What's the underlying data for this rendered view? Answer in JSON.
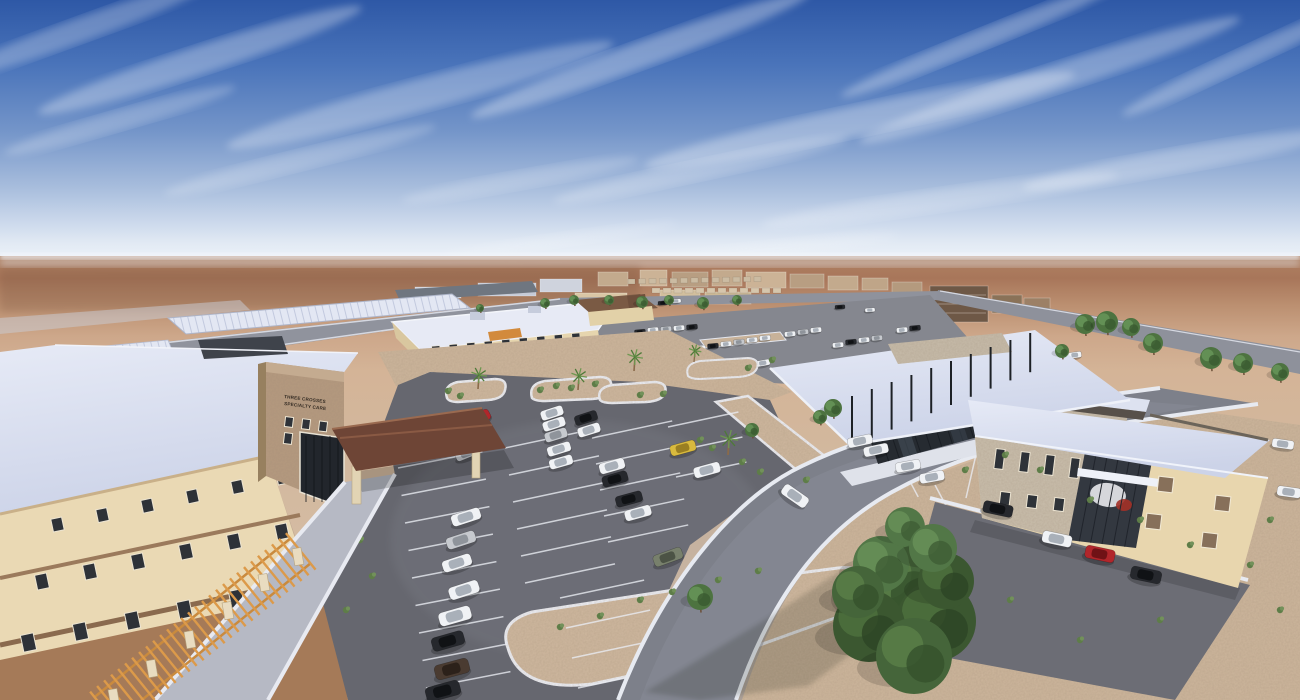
{
  "scene": {
    "description": "Aerial architectural rendering of a desert medical campus with parking lots",
    "sign": {
      "line1": "THREE CROSSES",
      "line2": "SPECIALTY CARE"
    }
  },
  "palette": {
    "sky_top": "#2e58a6",
    "sky_low": "#cdd9ec",
    "horizon_haze": "#eef3f9",
    "desert_far": "#a8765a",
    "desert_near": "#d5bea7",
    "gravel": "#cdb69c",
    "asphalt": "#66676f",
    "road": "#8f929c",
    "sidewalk": "#e8eaf1",
    "roof_white": "#dde2f2",
    "stucco": "#ead9b4",
    "brick": "#b59a7f",
    "stone": "#c9beac",
    "wood": "#dc9a4a",
    "canopy_brown": "#6e4536",
    "glass": "#262b31",
    "tree_green": "#45653a",
    "car_colors": {
      "W": [
        "#f0f2f5",
        "#a9b0b9"
      ],
      "S": [
        "#c6c9ce",
        "#8f949b"
      ],
      "K": [
        "#26282d",
        "#101215"
      ],
      "R": [
        "#b1262b",
        "#701216"
      ],
      "Y": [
        "#d9ba3e",
        "#9a7f22"
      ],
      "G": [
        "#78806c",
        "#4c5345"
      ],
      "N": [
        "#4a3b31",
        "#2c211a"
      ],
      "T": [
        "#4e7a88",
        "#2f4e58"
      ]
    },
    "tree_shades": [
      [
        "#45653a",
        "#567a45",
        "#35512c"
      ],
      [
        "#3b5730",
        "#4a6c3b",
        "#2d4525"
      ],
      [
        "#527747",
        "#648c55",
        "#3e5c35"
      ],
      [
        "#4d7340",
        "#639055",
        "#3a5a30"
      ]
    ]
  },
  "clouds": [
    [
      200,
      60,
      170,
      14,
      -18,
      0.3
    ],
    [
      420,
      95,
      200,
      16,
      -15,
      0.28
    ],
    [
      640,
      55,
      180,
      13,
      -20,
      0.32
    ],
    [
      860,
      120,
      220,
      15,
      -12,
      0.3
    ],
    [
      1050,
      80,
      200,
      14,
      -18,
      0.3
    ],
    [
      1180,
      160,
      160,
      12,
      -10,
      0.26
    ],
    [
      940,
      200,
      180,
      11,
      -8,
      0.22
    ],
    [
      700,
      170,
      150,
      10,
      -12,
      0.22
    ],
    [
      300,
      160,
      140,
      10,
      -14,
      0.2
    ],
    [
      980,
      40,
      150,
      10,
      -22,
      0.3
    ],
    [
      1240,
      60,
      130,
      10,
      -25,
      0.28
    ],
    [
      520,
      180,
      120,
      9,
      -10,
      0.18
    ],
    [
      120,
      120,
      120,
      10,
      -16,
      0.22
    ],
    [
      760,
      250,
      140,
      8,
      -6,
      0.15
    ],
    [
      560,
      240,
      120,
      7,
      -8,
      0.14
    ],
    [
      80,
      30,
      140,
      12,
      -20,
      0.26
    ]
  ],
  "distant_buildings": [
    [
      415,
      287,
      46,
      11,
      "#d0d4de"
    ],
    [
      478,
      283,
      58,
      13,
      "#c6cbd7"
    ],
    [
      540,
      279,
      42,
      13,
      "#cfd3dd"
    ],
    [
      598,
      272,
      30,
      14,
      "#c3aa8d"
    ],
    [
      640,
      270,
      27,
      16,
      "#ccb396"
    ],
    [
      672,
      272,
      36,
      15,
      "#b89e82"
    ],
    [
      712,
      270,
      30,
      16,
      "#c3aa8d"
    ],
    [
      746,
      272,
      40,
      16,
      "#ccb396"
    ],
    [
      790,
      274,
      34,
      14,
      "#b89e82"
    ],
    [
      828,
      276,
      30,
      14,
      "#c3aa8d"
    ],
    [
      862,
      278,
      26,
      12,
      "#bfa588"
    ],
    [
      892,
      282,
      30,
      12,
      "#b49a7e"
    ],
    [
      930,
      286,
      58,
      36,
      "#6e5846"
    ],
    [
      992,
      295,
      30,
      18,
      "#8a7258"
    ],
    [
      1024,
      298,
      26,
      14,
      "#9c8066"
    ],
    [
      575,
      293,
      52,
      13,
      "#d9c6a5"
    ],
    [
      660,
      290,
      40,
      12,
      "#d2bf9e"
    ],
    [
      705,
      292,
      46,
      12,
      "#cbb896"
    ]
  ],
  "house_rows": [
    [
      628,
      279,
      10.5,
      -0.2,
      7,
      5,
      13,
      "#cbbba2"
    ],
    [
      652,
      288,
      11,
      0,
      8,
      5,
      12,
      "#d6c6ac"
    ]
  ],
  "stall_rows": [
    [
      398,
      468,
      3.5,
      27.5,
      86,
      -11,
      9
    ],
    [
      505,
      448,
      4,
      27,
      92,
      -12,
      6
    ],
    [
      592,
      438,
      4,
      26,
      82,
      -12,
      5
    ],
    [
      668,
      427,
      4,
      25,
      72,
      -12,
      3
    ],
    [
      560,
      598,
      6,
      30,
      86,
      -12,
      4
    ],
    [
      966,
      498,
      45,
      11.5,
      46,
      -77,
      6
    ],
    [
      848,
      452,
      29,
      11,
      26,
      62,
      4
    ]
  ],
  "window_rows": [
    {
      "g": "wLeft",
      "x": 52,
      "y": 518,
      "dx": 45,
      "dy": -9.4,
      "w": 11,
      "h": 13,
      "n": 6,
      "rot": -12
    },
    {
      "g": "wLeft",
      "x": 36,
      "y": 574,
      "dx": 48,
      "dy": -10,
      "w": 12,
      "h": 15,
      "n": 6,
      "rot": -12
    },
    {
      "g": "wLeft",
      "x": 22,
      "y": 634,
      "dx": 52,
      "dy": -11,
      "w": 13,
      "h": 17,
      "n": 5,
      "rot": -12
    },
    {
      "g": "wTower",
      "x": 285,
      "y": 417,
      "dx": 17,
      "dy": 2.2,
      "w": 8,
      "h": 10,
      "n": 3,
      "rot": 7
    },
    {
      "g": "wTower",
      "x": 284,
      "y": 433,
      "dx": 17,
      "dy": 2.2,
      "w": 8,
      "h": 11,
      "n": 3,
      "rot": 7
    },
    {
      "g": "wClinic",
      "x": 432,
      "y": 346,
      "dx": 17.5,
      "dy": -1.6,
      "w": 8,
      "h": 8,
      "n": 9,
      "rot": -5,
      "s": 0.6
    },
    {
      "g": "wRStone",
      "x": 995,
      "y": 449,
      "dx": 25,
      "dy": 3,
      "w": 9,
      "h": 20,
      "n": 4,
      "rot": 7
    },
    {
      "g": "wRStone",
      "x": 1000,
      "y": 492,
      "dx": 27,
      "dy": 3,
      "w": 10,
      "h": 13,
      "n": 3,
      "rot": 7
    }
  ],
  "win_rects": [
    [
      1158,
      477,
      15,
      15,
      7
    ],
    [
      1215,
      496,
      15,
      15,
      7
    ],
    [
      1146,
      514,
      15,
      15,
      7
    ],
    [
      1202,
      533,
      15,
      15,
      7
    ]
  ],
  "cars": [
    [
      478,
      419,
      -28,
      "R",
      26,
      11
    ],
    [
      476,
      431,
      -24,
      "W",
      26,
      11
    ],
    [
      473,
      443,
      -22,
      "W",
      25,
      10
    ],
    [
      467,
      453,
      -22,
      "S",
      24,
      10
    ],
    [
      466,
      517,
      -18,
      "W",
      30,
      12
    ],
    [
      461,
      540,
      -18,
      "S",
      30,
      12
    ],
    [
      457,
      563,
      -18,
      "W",
      30,
      12
    ],
    [
      464,
      590,
      -18,
      "W",
      31,
      13
    ],
    [
      455,
      616,
      -16,
      "W",
      33,
      14
    ],
    [
      448,
      641,
      -16,
      "K",
      33,
      14
    ],
    [
      452,
      669,
      -15,
      "N",
      35,
      15
    ],
    [
      443,
      691,
      -15,
      "K",
      35,
      15
    ],
    [
      552,
      413,
      -18,
      "W",
      23,
      10
    ],
    [
      554,
      424,
      -18,
      "W",
      23,
      10
    ],
    [
      556,
      435,
      -17,
      "S",
      23,
      10
    ],
    [
      559,
      449,
      -17,
      "W",
      24,
      10
    ],
    [
      561,
      462,
      -16,
      "W",
      24,
      10
    ],
    [
      586,
      418,
      -18,
      "K",
      23,
      10
    ],
    [
      589,
      430,
      -17,
      "W",
      23,
      10
    ],
    [
      612,
      466,
      -16,
      "W",
      26,
      11
    ],
    [
      615,
      479,
      -16,
      "K",
      26,
      11
    ],
    [
      629,
      499,
      -15,
      "K",
      27,
      11
    ],
    [
      638,
      513,
      -15,
      "W",
      27,
      11
    ],
    [
      668,
      557,
      -20,
      "G",
      30,
      12
    ],
    [
      683,
      448,
      -15,
      "Y",
      26,
      11
    ],
    [
      707,
      470,
      -15,
      "W",
      27,
      11
    ],
    [
      795,
      496,
      35,
      "W",
      29,
      12
    ],
    [
      860,
      441,
      -12,
      "W",
      25,
      10
    ],
    [
      876,
      450,
      -12,
      "W",
      25,
      10
    ],
    [
      908,
      466,
      -10,
      "W",
      25,
      10
    ],
    [
      932,
      477,
      -10,
      "W",
      25,
      10
    ],
    [
      998,
      509,
      12,
      "K",
      30,
      12
    ],
    [
      1057,
      539,
      12,
      "W",
      30,
      12
    ],
    [
      1100,
      554,
      12,
      "R",
      30,
      13
    ],
    [
      1146,
      575,
      12,
      "K",
      31,
      13
    ],
    [
      1283,
      444,
      8,
      "W",
      22,
      9
    ],
    [
      1289,
      492,
      8,
      "W",
      24,
      10
    ]
  ],
  "cars_far": [
    [
      405,
      371,
      -20,
      "R",
      15,
      7
    ],
    [
      417,
      373,
      -20,
      "W",
      15,
      7
    ],
    [
      429,
      370,
      -20,
      "W",
      15,
      7
    ],
    [
      449,
      368,
      -20,
      "S",
      15,
      7
    ],
    [
      500,
      388,
      -15,
      "W",
      15,
      7
    ],
    [
      512,
      390,
      -15,
      "S",
      15,
      7
    ],
    [
      537,
      387,
      -15,
      "W",
      15,
      7
    ],
    [
      549,
      385,
      -15,
      "W",
      15,
      7
    ],
    [
      558,
      383,
      -15,
      "K",
      15,
      7
    ],
    [
      655,
      382,
      -12,
      "W",
      15,
      7
    ],
    [
      668,
      408,
      -14,
      "K",
      17,
      8
    ],
    [
      681,
      413,
      -14,
      "K",
      17,
      8
    ],
    [
      707,
      382,
      -12,
      "T",
      15,
      7
    ],
    [
      763,
      363,
      -10,
      "W",
      14,
      6
    ],
    [
      645,
      405,
      -14,
      "W",
      17,
      8
    ],
    [
      657,
      420,
      -14,
      "W",
      17,
      8
    ],
    [
      1160,
      402,
      8,
      "W",
      16,
      7
    ],
    [
      1178,
      406,
      8,
      "K",
      16,
      7
    ],
    [
      1196,
      410,
      8,
      "W",
      16,
      7
    ],
    [
      1030,
      345,
      -8,
      "W",
      13,
      6
    ],
    [
      1043,
      347,
      -8,
      "S",
      13,
      6
    ],
    [
      1075,
      355,
      -8,
      "W",
      13,
      6
    ],
    [
      608,
      364,
      -5,
      "W",
      11,
      5
    ],
    [
      621,
      361,
      -5,
      "S",
      11,
      5
    ],
    [
      634,
      358,
      -5,
      "K",
      11,
      5
    ],
    [
      647,
      356,
      -5,
      "W",
      11,
      5
    ],
    [
      660,
      354,
      -5,
      "W",
      11,
      5
    ],
    [
      673,
      352,
      -5,
      "S",
      11,
      5
    ],
    [
      700,
      348,
      -5,
      "W",
      11,
      5
    ],
    [
      713,
      346,
      -5,
      "K",
      11,
      5
    ],
    [
      726,
      344,
      -5,
      "W",
      11,
      5
    ],
    [
      739,
      342,
      -5,
      "S",
      11,
      5
    ],
    [
      752,
      340,
      -5,
      "W",
      11,
      5
    ],
    [
      765,
      338,
      -5,
      "W",
      11,
      5
    ],
    [
      640,
      332,
      -5,
      "K",
      11,
      5
    ],
    [
      653,
      330,
      -5,
      "W",
      11,
      5
    ],
    [
      666,
      329,
      -5,
      "S",
      11,
      5
    ],
    [
      679,
      328,
      -5,
      "W",
      11,
      5
    ],
    [
      692,
      327,
      -5,
      "K",
      11,
      5
    ],
    [
      790,
      334,
      -5,
      "W",
      11,
      5
    ],
    [
      803,
      332,
      -5,
      "S",
      11,
      5
    ],
    [
      816,
      330,
      -5,
      "W",
      11,
      5
    ],
    [
      838,
      345,
      -5,
      "W",
      11,
      5
    ],
    [
      851,
      342,
      -5,
      "K",
      11,
      5
    ],
    [
      864,
      340,
      -5,
      "W",
      11,
      5
    ],
    [
      877,
      338,
      -5,
      "S",
      11,
      5
    ],
    [
      902,
      330,
      -5,
      "W",
      11,
      5
    ],
    [
      915,
      328,
      -5,
      "K",
      11,
      5
    ],
    [
      663,
      303,
      -4,
      "K",
      10,
      4
    ],
    [
      676,
      301,
      -4,
      "W",
      10,
      4
    ],
    [
      840,
      307,
      -4,
      "K",
      10,
      4
    ],
    [
      870,
      310,
      -4,
      "W",
      10,
      4
    ]
  ],
  "trees": [
    [
      900,
      585,
      46,
      0
    ],
    [
      936,
      621,
      40,
      1
    ],
    [
      869,
      626,
      36,
      1
    ],
    [
      914,
      656,
      38,
      0
    ],
    [
      881,
      564,
      28,
      2
    ],
    [
      946,
      581,
      28,
      1
    ],
    [
      905,
      527,
      20,
      2
    ],
    [
      858,
      592,
      26,
      0
    ],
    [
      933,
      548,
      24,
      2
    ],
    [
      1085,
      324,
      10,
      3
    ],
    [
      1107,
      322,
      11,
      3
    ],
    [
      1131,
      327,
      9,
      3
    ],
    [
      1153,
      343,
      10,
      3
    ],
    [
      1211,
      358,
      11,
      3
    ],
    [
      1243,
      363,
      10,
      3
    ],
    [
      1280,
      372,
      9,
      3
    ],
    [
      1062,
      351,
      7,
      3
    ],
    [
      833,
      408,
      9,
      3
    ],
    [
      820,
      417,
      7,
      3
    ],
    [
      700,
      597,
      13,
      3
    ],
    [
      752,
      430,
      7,
      3
    ],
    [
      545,
      303,
      5,
      3
    ],
    [
      574,
      300,
      5,
      3
    ],
    [
      609,
      300,
      5,
      3
    ],
    [
      642,
      302,
      6,
      3
    ],
    [
      669,
      300,
      5,
      3
    ],
    [
      703,
      303,
      6,
      3
    ],
    [
      737,
      300,
      5,
      3
    ],
    [
      480,
      308,
      4,
      3
    ]
  ],
  "palms": [
    [
      478,
      389,
      1
    ],
    [
      578,
      390,
      1
    ],
    [
      634,
      371,
      1
    ],
    [
      694,
      362,
      0.8
    ],
    [
      728,
      455,
      1.15
    ]
  ],
  "shrubs": [
    [
      540,
      390
    ],
    [
      556,
      386
    ],
    [
      571,
      388
    ],
    [
      595,
      384
    ],
    [
      460,
      396
    ],
    [
      448,
      391
    ],
    [
      663,
      394
    ],
    [
      640,
      395
    ],
    [
      700,
      440
    ],
    [
      712,
      448
    ],
    [
      742,
      462
    ],
    [
      760,
      472
    ],
    [
      640,
      600
    ],
    [
      672,
      592
    ],
    [
      718,
      580
    ],
    [
      758,
      571
    ],
    [
      560,
      627
    ],
    [
      600,
      616
    ],
    [
      806,
      480
    ],
    [
      1005,
      455
    ],
    [
      1040,
      470
    ],
    [
      1090,
      500
    ],
    [
      1140,
      520
    ],
    [
      1190,
      545
    ],
    [
      1250,
      565
    ],
    [
      1280,
      610
    ],
    [
      1160,
      620
    ],
    [
      1080,
      640
    ],
    [
      1010,
      600
    ],
    [
      965,
      470
    ],
    [
      1270,
      520
    ],
    [
      360,
      540
    ],
    [
      372,
      576
    ],
    [
      346,
      610
    ],
    [
      748,
      368
    ],
    [
      772,
      360
    ]
  ],
  "pergola": {
    "x": 92,
    "y": 694,
    "angle": -39,
    "len": 252,
    "width": 42,
    "step": 9
  },
  "pergola_columns": [
    [
      108,
      690
    ],
    [
      146,
      661
    ],
    [
      184,
      632
    ],
    [
      222,
      603
    ],
    [
      258,
      575
    ],
    [
      292,
      549
    ]
  ]
}
